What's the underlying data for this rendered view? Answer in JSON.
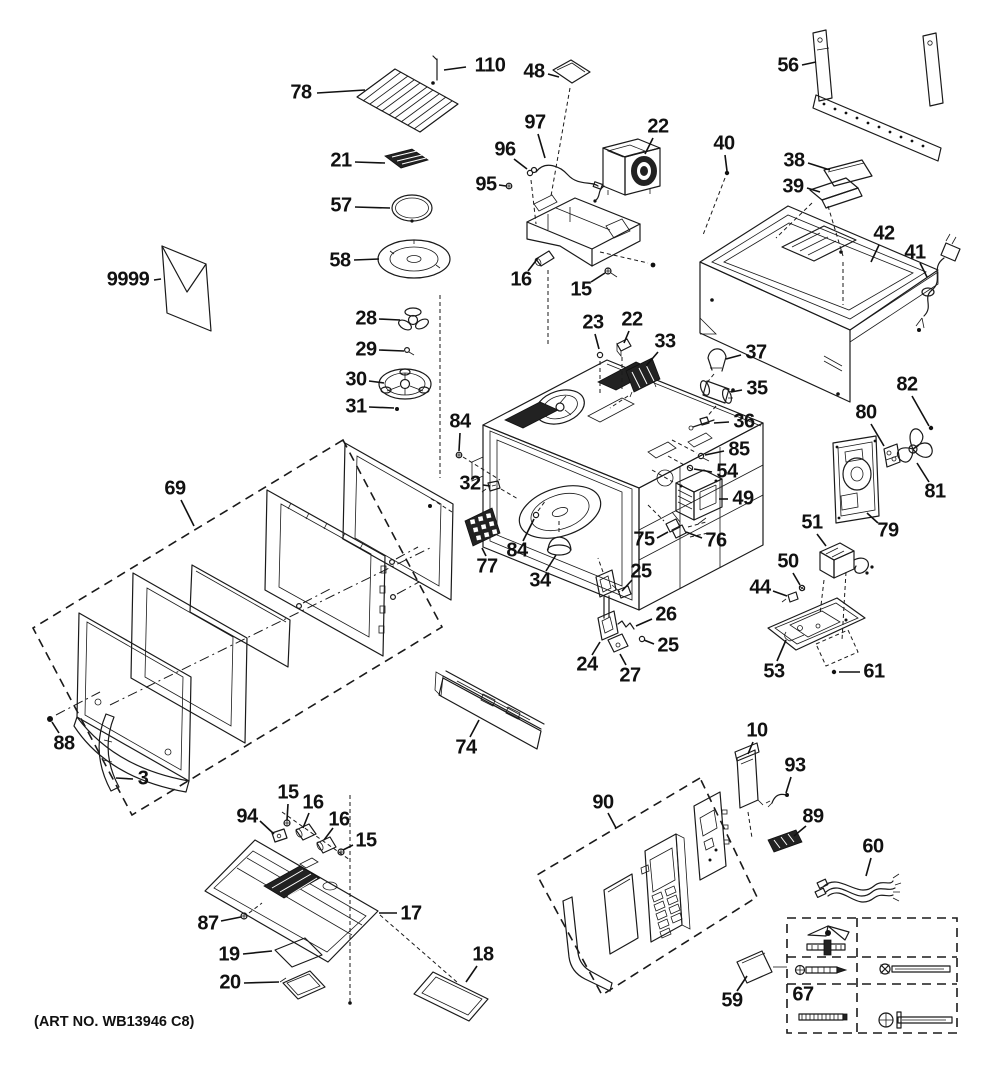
{
  "art_no": "(ART NO. WB13946 C8)",
  "diagram_type": "exploded-parts-diagram",
  "colors": {
    "line": "#1a1a1a",
    "background": "#ffffff",
    "label": "#111111"
  },
  "callouts": [
    {
      "id": "110",
      "num": "110",
      "x": 490,
      "y": 66,
      "ax": 466,
      "ay": 67,
      "tx": 444,
      "ty": 70
    },
    {
      "id": "78",
      "num": "78",
      "x": 301,
      "y": 93,
      "ax": 317,
      "ay": 93,
      "tx": 365,
      "ty": 90
    },
    {
      "id": "48",
      "num": "48",
      "x": 534,
      "y": 72,
      "ax": 548,
      "ay": 74,
      "tx": 559,
      "ty": 77
    },
    {
      "id": "56",
      "num": "56",
      "x": 788,
      "y": 66,
      "ax": 802,
      "ay": 65,
      "tx": 816,
      "ty": 62
    },
    {
      "id": "97",
      "num": "97",
      "x": 535,
      "y": 123,
      "ax": 538,
      "ay": 134,
      "tx": 545,
      "ty": 158
    },
    {
      "id": "96",
      "num": "96",
      "x": 505,
      "y": 150,
      "ax": 514,
      "ay": 159,
      "tx": 527,
      "ty": 169
    },
    {
      "id": "95",
      "num": "95",
      "x": 486,
      "y": 185,
      "ax": 499,
      "ay": 185,
      "tx": 506,
      "ty": 186
    },
    {
      "id": "22a",
      "num": "22",
      "x": 658,
      "y": 127,
      "ax": 653,
      "ay": 138,
      "tx": 645,
      "ty": 154
    },
    {
      "id": "40",
      "num": "40",
      "x": 724,
      "y": 144,
      "ax": 725,
      "ay": 155,
      "tx": 727,
      "ty": 171
    },
    {
      "id": "38",
      "num": "38",
      "x": 794,
      "y": 161,
      "ax": 808,
      "ay": 163,
      "tx": 830,
      "ty": 170
    },
    {
      "id": "39",
      "num": "39",
      "x": 793,
      "y": 187,
      "ax": 807,
      "ay": 188,
      "tx": 820,
      "ty": 192
    },
    {
      "id": "42",
      "num": "42",
      "x": 884,
      "y": 234,
      "ax": 879,
      "ay": 245,
      "tx": 871,
      "ty": 262
    },
    {
      "id": "41",
      "num": "41",
      "x": 915,
      "y": 253,
      "ax": 920,
      "ay": 263,
      "tx": 927,
      "ty": 277
    },
    {
      "id": "21",
      "num": "21",
      "x": 341,
      "y": 161,
      "ax": 355,
      "ay": 162,
      "tx": 385,
      "ty": 163
    },
    {
      "id": "57",
      "num": "57",
      "x": 341,
      "y": 206,
      "ax": 355,
      "ay": 207,
      "tx": 390,
      "ty": 208
    },
    {
      "id": "58",
      "num": "58",
      "x": 340,
      "y": 261,
      "ax": 354,
      "ay": 260,
      "tx": 379,
      "ty": 259
    },
    {
      "id": "9999",
      "num": "9999",
      "x": 128,
      "y": 280,
      "ax": 154,
      "ay": 280,
      "tx": 161,
      "ty": 279
    },
    {
      "id": "16a",
      "num": "16",
      "x": 521,
      "y": 280,
      "ax": 528,
      "ay": 271,
      "tx": 538,
      "ty": 258
    },
    {
      "id": "15a",
      "num": "15",
      "x": 581,
      "y": 290,
      "ax": 591,
      "ay": 282,
      "tx": 605,
      "ty": 273
    },
    {
      "id": "28",
      "num": "28",
      "x": 366,
      "y": 319,
      "ax": 379,
      "ay": 319,
      "tx": 400,
      "ty": 320
    },
    {
      "id": "29",
      "num": "29",
      "x": 366,
      "y": 350,
      "ax": 379,
      "ay": 350,
      "tx": 404,
      "ty": 351
    },
    {
      "id": "30",
      "num": "30",
      "x": 356,
      "y": 380,
      "ax": 369,
      "ay": 381,
      "tx": 384,
      "ty": 383
    },
    {
      "id": "31",
      "num": "31",
      "x": 356,
      "y": 407,
      "ax": 369,
      "ay": 407,
      "tx": 394,
      "ty": 408
    },
    {
      "id": "23",
      "num": "23",
      "x": 593,
      "y": 323,
      "ax": 595,
      "ay": 334,
      "tx": 599,
      "ty": 349
    },
    {
      "id": "22b",
      "num": "22",
      "x": 632,
      "y": 320,
      "ax": 629,
      "ay": 331,
      "tx": 624,
      "ty": 343
    },
    {
      "id": "33",
      "num": "33",
      "x": 665,
      "y": 342,
      "ax": 658,
      "ay": 352,
      "tx": 646,
      "ty": 366
    },
    {
      "id": "37",
      "num": "37",
      "x": 756,
      "y": 353,
      "ax": 741,
      "ay": 355,
      "tx": 726,
      "ty": 359
    },
    {
      "id": "35",
      "num": "35",
      "x": 757,
      "y": 389,
      "ax": 742,
      "ay": 390,
      "tx": 731,
      "ty": 392
    },
    {
      "id": "36",
      "num": "36",
      "x": 744,
      "y": 422,
      "ax": 729,
      "ay": 422,
      "tx": 714,
      "ty": 423
    },
    {
      "id": "84a",
      "num": "84",
      "x": 460,
      "y": 422,
      "ax": 460,
      "ay": 433,
      "tx": 459,
      "ty": 451
    },
    {
      "id": "85",
      "num": "85",
      "x": 739,
      "y": 450,
      "ax": 724,
      "ay": 451,
      "tx": 705,
      "ty": 455
    },
    {
      "id": "54",
      "num": "54",
      "x": 727,
      "y": 472,
      "ax": 712,
      "ay": 472,
      "tx": 694,
      "ty": 469
    },
    {
      "id": "49",
      "num": "49",
      "x": 743,
      "y": 499,
      "ax": 728,
      "ay": 499,
      "tx": 719,
      "ty": 499
    },
    {
      "id": "32",
      "num": "32",
      "x": 470,
      "y": 484,
      "ax": 483,
      "ay": 485,
      "tx": 490,
      "ty": 486
    },
    {
      "id": "84b",
      "num": "84",
      "x": 517,
      "y": 551,
      "ax": 523,
      "ay": 541,
      "tx": 534,
      "ty": 519
    },
    {
      "id": "77",
      "num": "77",
      "x": 487,
      "y": 567,
      "ax": 486,
      "ay": 556,
      "tx": 482,
      "ty": 548
    },
    {
      "id": "34",
      "num": "34",
      "x": 540,
      "y": 581,
      "ax": 546,
      "ay": 571,
      "tx": 556,
      "ty": 555
    },
    {
      "id": "75",
      "num": "75",
      "x": 644,
      "y": 540,
      "ax": 657,
      "ay": 538,
      "tx": 668,
      "ty": 532
    },
    {
      "id": "76",
      "num": "76",
      "x": 716,
      "y": 541,
      "ax": 702,
      "ay": 538,
      "tx": 686,
      "ty": 532
    },
    {
      "id": "80",
      "num": "80",
      "x": 866,
      "y": 413,
      "ax": 871,
      "ay": 424,
      "tx": 884,
      "ty": 446
    },
    {
      "id": "82",
      "num": "82",
      "x": 907,
      "y": 385,
      "ax": 912,
      "ay": 396,
      "tx": 929,
      "ty": 426
    },
    {
      "id": "81",
      "num": "81",
      "x": 935,
      "y": 492,
      "ax": 929,
      "ay": 482,
      "tx": 917,
      "ty": 463
    },
    {
      "id": "79",
      "num": "79",
      "x": 888,
      "y": 531,
      "ax": 878,
      "ay": 523,
      "tx": 867,
      "ty": 513
    },
    {
      "id": "51",
      "num": "51",
      "x": 812,
      "y": 523,
      "ax": 817,
      "ay": 534,
      "tx": 826,
      "ty": 546
    },
    {
      "id": "50",
      "num": "50",
      "x": 788,
      "y": 562,
      "ax": 793,
      "ay": 573,
      "tx": 800,
      "ty": 585
    },
    {
      "id": "44",
      "num": "44",
      "x": 760,
      "y": 588,
      "ax": 773,
      "ay": 591,
      "tx": 787,
      "ty": 596
    },
    {
      "id": "53",
      "num": "53",
      "x": 774,
      "y": 672,
      "ax": 777,
      "ay": 661,
      "tx": 786,
      "ty": 640
    },
    {
      "id": "61",
      "num": "61",
      "x": 874,
      "y": 672,
      "ax": 860,
      "ay": 672,
      "tx": 839,
      "ty": 672
    },
    {
      "id": "25a",
      "num": "25",
      "x": 641,
      "y": 572,
      "ax": 632,
      "ay": 580,
      "tx": 622,
      "ty": 591
    },
    {
      "id": "26",
      "num": "26",
      "x": 666,
      "y": 615,
      "ax": 652,
      "ay": 619,
      "tx": 636,
      "ty": 626
    },
    {
      "id": "25b",
      "num": "25",
      "x": 668,
      "y": 646,
      "ax": 654,
      "ay": 644,
      "tx": 644,
      "ty": 640
    },
    {
      "id": "24",
      "num": "24",
      "x": 587,
      "y": 665,
      "ax": 592,
      "ay": 655,
      "tx": 600,
      "ty": 642
    },
    {
      "id": "27",
      "num": "27",
      "x": 630,
      "y": 676,
      "ax": 626,
      "ay": 665,
      "tx": 620,
      "ty": 654
    },
    {
      "id": "69",
      "num": "69",
      "x": 175,
      "y": 489,
      "ax": 181,
      "ay": 500,
      "tx": 194,
      "ty": 526
    },
    {
      "id": "88",
      "num": "88",
      "x": 64,
      "y": 744,
      "ax": 59,
      "ay": 733,
      "tx": 52,
      "ty": 722
    },
    {
      "id": "3",
      "num": "3",
      "x": 143,
      "y": 779,
      "ax": 133,
      "ay": 779,
      "tx": 116,
      "ty": 778
    },
    {
      "id": "74",
      "num": "74",
      "x": 466,
      "y": 748,
      "ax": 470,
      "ay": 737,
      "tx": 479,
      "ty": 720
    },
    {
      "id": "90",
      "num": "90",
      "x": 603,
      "y": 803,
      "ax": 608,
      "ay": 813,
      "tx": 616,
      "ty": 828
    },
    {
      "id": "10",
      "num": "10",
      "x": 757,
      "y": 731,
      "ax": 753,
      "ay": 742,
      "tx": 748,
      "ty": 754
    },
    {
      "id": "93",
      "num": "93",
      "x": 795,
      "y": 766,
      "ax": 791,
      "ay": 777,
      "tx": 786,
      "ty": 793
    },
    {
      "id": "89",
      "num": "89",
      "x": 813,
      "y": 817,
      "ax": 806,
      "ay": 826,
      "tx": 794,
      "ty": 836
    },
    {
      "id": "60",
      "num": "60",
      "x": 873,
      "y": 847,
      "ax": 871,
      "ay": 858,
      "tx": 866,
      "ty": 876
    },
    {
      "id": "59",
      "num": "59",
      "x": 732,
      "y": 1001,
      "ax": 737,
      "ay": 991,
      "tx": 747,
      "ty": 976
    },
    {
      "id": "67",
      "num": "67",
      "x": 803,
      "y": 995
    },
    {
      "id": "94",
      "num": "94",
      "x": 247,
      "y": 817,
      "ax": 260,
      "ay": 821,
      "tx": 274,
      "ty": 834
    },
    {
      "id": "15b",
      "num": "15",
      "x": 288,
      "y": 793,
      "ax": 288,
      "ay": 804,
      "tx": 287,
      "ty": 820
    },
    {
      "id": "16b",
      "num": "16",
      "x": 313,
      "y": 803,
      "ax": 309,
      "ay": 813,
      "tx": 303,
      "ty": 828
    },
    {
      "id": "16c",
      "num": "16",
      "x": 339,
      "y": 820,
      "ax": 333,
      "ay": 828,
      "tx": 324,
      "ty": 840
    },
    {
      "id": "15c",
      "num": "15",
      "x": 366,
      "y": 841,
      "ax": 353,
      "ay": 845,
      "tx": 343,
      "ty": 850
    },
    {
      "id": "17",
      "num": "17",
      "x": 411,
      "y": 914,
      "ax": 397,
      "ay": 913,
      "tx": 379,
      "ty": 913
    },
    {
      "id": "87",
      "num": "87",
      "x": 208,
      "y": 924,
      "ax": 221,
      "ay": 921,
      "tx": 241,
      "ty": 917
    },
    {
      "id": "19",
      "num": "19",
      "x": 229,
      "y": 955,
      "ax": 243,
      "ay": 954,
      "tx": 272,
      "ty": 951
    },
    {
      "id": "20",
      "num": "20",
      "x": 230,
      "y": 983,
      "ax": 244,
      "ay": 983,
      "tx": 279,
      "ty": 982
    },
    {
      "id": "18",
      "num": "18",
      "x": 483,
      "y": 955,
      "ax": 477,
      "ay": 966,
      "tx": 466,
      "ty": 982
    }
  ]
}
